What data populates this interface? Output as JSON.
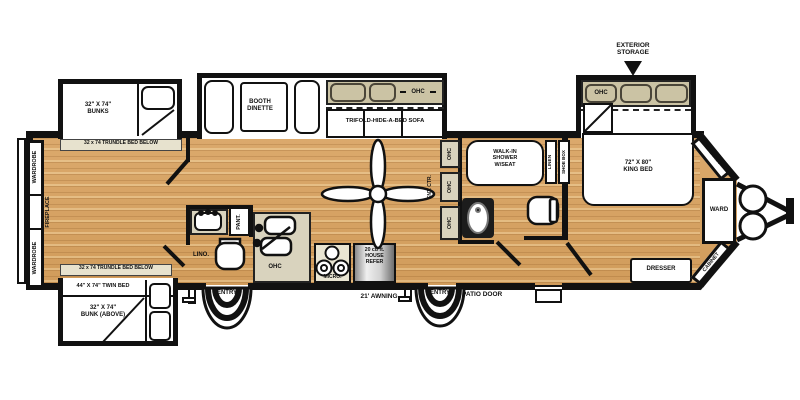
{
  "colors": {
    "wood": "#D8A468",
    "beige": "#D9D3BE",
    "tan": "#CBC3A4",
    "wall": "#111111"
  },
  "labels": {
    "wardrobe_top": "WARDROBE",
    "wardrobe_bottom": "WARDROBE",
    "fireplace": "FIREPLACE",
    "bunks": "32\" X 74\"\nBUNKS",
    "trundle_top": "32 x 74 TRUNDLE BED BELOW",
    "trundle_bottom": "32 x 74 TRUNDLE BED BELOW",
    "twin_bed": "44\" X 74\" TWIN BED",
    "bunk_above": "32\" X 74\"\nBUNK (ABOVE)",
    "booth_dinette": "BOOTH\nDINETTE",
    "sofa": "TRIFOLD-HIDE-A-BED SOFA",
    "sofa_ohc": "OHC",
    "lino": "LINO.",
    "pantry": "PANT.",
    "kitchen_ohc": "OHC",
    "micro": "MICRO.",
    "refer": "20 cu ft.\nHOUSE\nREFER",
    "awning": "21' AWNING",
    "entry_left": "ENTRY",
    "entry_right": "ENTRY",
    "patio_door": "PATIO DOOR",
    "ent_ctr": "ENT. CTR.",
    "ohc_upper": "OHC",
    "ohc_middle": "OHC",
    "ohc_lower": "OHC",
    "shower": "WALK-IN\nSHOWER\nW/SEAT",
    "linen": "LINEN",
    "shoe_box": "SHOE BOX",
    "exterior_storage": "EXTERIOR\nSTORAGE",
    "bed_ohc": "OHC",
    "king_bed": "72\" X 80\"\nKING BED",
    "cabinet_top": "CABINET",
    "cabinet_bottom": "CABINET",
    "ward": "WARD",
    "dresser": "DRESSER"
  }
}
